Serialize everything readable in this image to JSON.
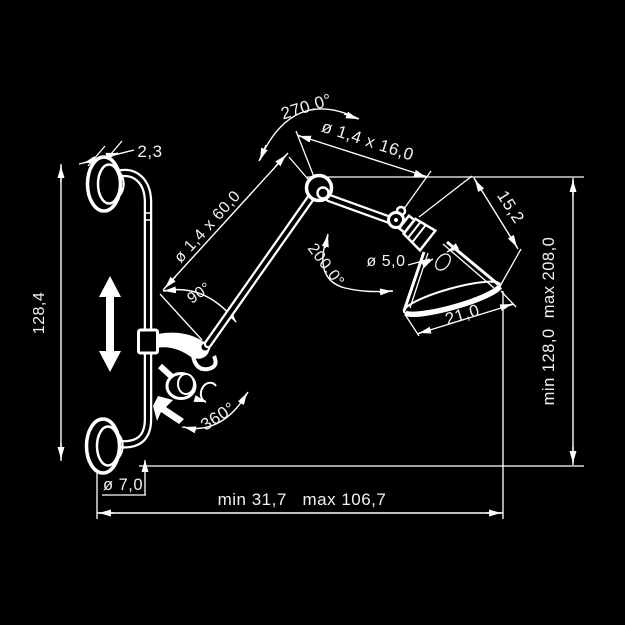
{
  "drawing": {
    "kind": "technical dimension drawing",
    "subject": "articulated wall lamp with swing arm",
    "background_color": "#000000",
    "line_color": "#ffffff",
    "text_color": "#f2f2f2"
  },
  "labels": {
    "disc_thickness": "2,3",
    "pole_length": "128,4",
    "lower_arm": "ø 1,4 x 60,0",
    "arm_angle": "90°",
    "elbow_rotation": "270.0°",
    "upper_arm": "ø 1,4 x 16,0",
    "head_length": "15,2",
    "head_tilt": "200.0°",
    "socket_diameter": "ø 5,0",
    "shade_opening": "21,0",
    "height_range": "min 128,0  max 208,0",
    "base_rotation": "360°",
    "tube_diameter": "ø 7,0",
    "reach_range": "min 31,7   max 106,7"
  }
}
